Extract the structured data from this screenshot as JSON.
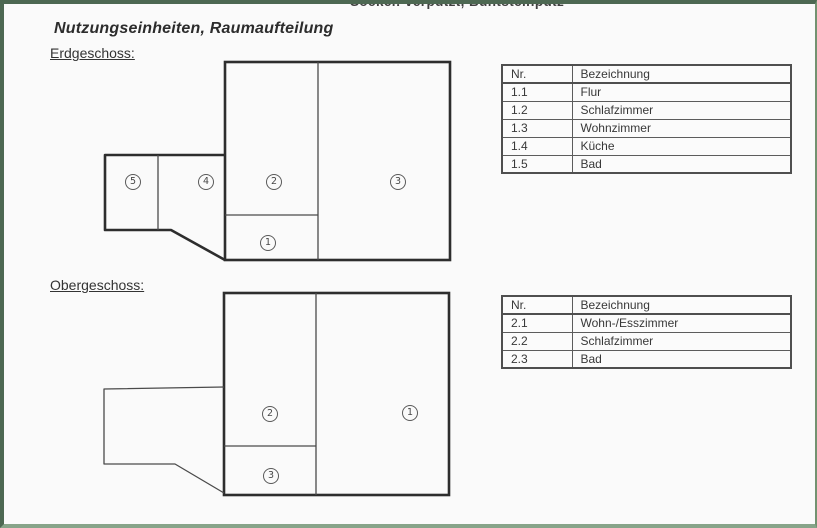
{
  "clipped_top_text": "Sockel: verputzt, Buntsteinputz",
  "title": "Nutzungseinheiten, Raumaufteilung",
  "floors": [
    {
      "heading": "Erdgeschoss:",
      "table": {
        "headers": [
          "Nr.",
          "Bezeichnung"
        ],
        "rows": [
          [
            "1.1",
            "Flur"
          ],
          [
            "1.2",
            "Schlafzimmer"
          ],
          [
            "1.3",
            "Wohnzimmer"
          ],
          [
            "1.4",
            "Küche"
          ],
          [
            "1.5",
            "Bad"
          ]
        ]
      },
      "plan_labels": [
        "1",
        "2",
        "3",
        "4",
        "5"
      ]
    },
    {
      "heading": "Obergeschoss:",
      "table": {
        "headers": [
          "Nr.",
          "Bezeichnung"
        ],
        "rows": [
          [
            "2.1",
            "Wohn-/Esszimmer"
          ],
          [
            "2.2",
            "Schlafzimmer"
          ],
          [
            "2.3",
            "Bad"
          ]
        ]
      },
      "plan_labels": [
        "1",
        "2",
        "3"
      ]
    }
  ],
  "colors": {
    "page_border_green": "#5f7f62",
    "plan_line_dark": "#2d2d2d",
    "plan_line_thin": "#4a4a4a"
  }
}
